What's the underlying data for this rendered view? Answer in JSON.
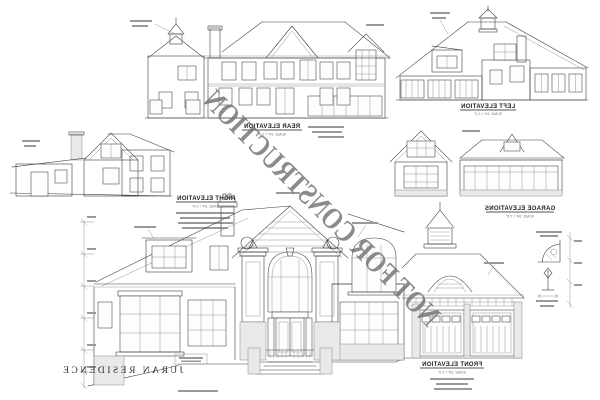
{
  "sheet": {
    "watermark": "NOT FOR CONSTRUCTION",
    "project_title": "JURAN RESIDENCE"
  },
  "colors": {
    "line": "#3d3d3d",
    "light_line": "#8a8a8a",
    "stone_fill": "#e9e9e9",
    "watermark": "#6f6f6f",
    "label": "#1c1c1c"
  },
  "views": {
    "rear": {
      "title": "REAR ELEVATION",
      "scale": "SCALE: 1/4\" = 1'-0\""
    },
    "left": {
      "title": "LEFT ELEVATION",
      "scale": "SCALE: 1/4\" = 1'-0\""
    },
    "right": {
      "title": "RIGHT ELEVATION",
      "scale": "SCALE: 1/4\" = 1'-0\""
    },
    "garage": {
      "title": "GARAGE ELEVATIONS",
      "scale": "SCALE: 1/4\" = 1'-0\""
    },
    "front": {
      "title": "FRONT ELEVATION",
      "scale": "SCALE: 1/4\" = 1'-0\""
    }
  }
}
